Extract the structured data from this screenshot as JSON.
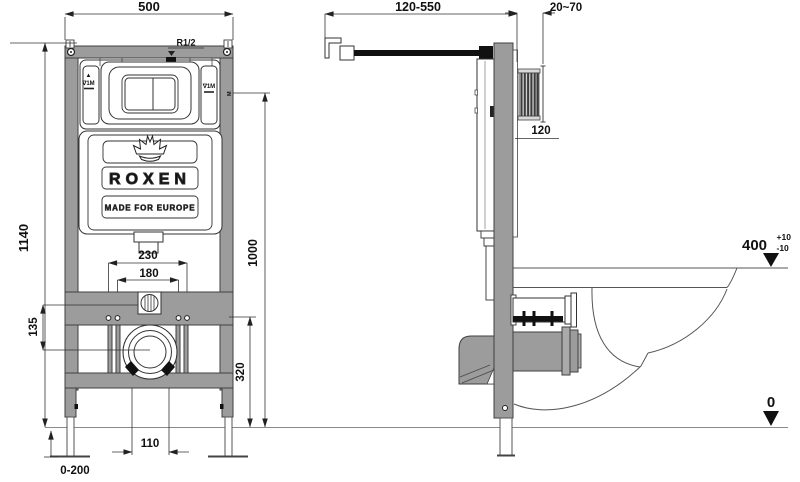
{
  "drawing": {
    "type": "wall-hung toilet installation frame — dimensional drawing",
    "brand": {
      "name": "ROXEN",
      "tagline": "MADE FOR EUROPE"
    },
    "front_view": {
      "dim_width": "500",
      "dim_height": "1140",
      "dim_stud_outer": "230",
      "dim_stud_inner": "180",
      "dim_inlet_to_drain": "135",
      "dim_fixing_height": "320",
      "dim_plate_height": "1000",
      "dim_outlet": "110",
      "dim_feet": "0-200",
      "label_inlet": "R1/2",
      "label_level_left": "∇1M",
      "label_level_right": "∇1M",
      "label_level_arrow": "▲",
      "label_meter": "M"
    },
    "side_view": {
      "dim_rod": "120-550",
      "dim_wall": "20~70",
      "dim_depth": "120",
      "dim_bowl_height": "400",
      "dim_bowl_tol_up": "+10",
      "dim_bowl_tol_down": "-10",
      "dim_floor": "0"
    },
    "colors": {
      "frame": "#9c9c9c",
      "outline": "#3f3f3f",
      "dim_text": "#111111"
    }
  }
}
